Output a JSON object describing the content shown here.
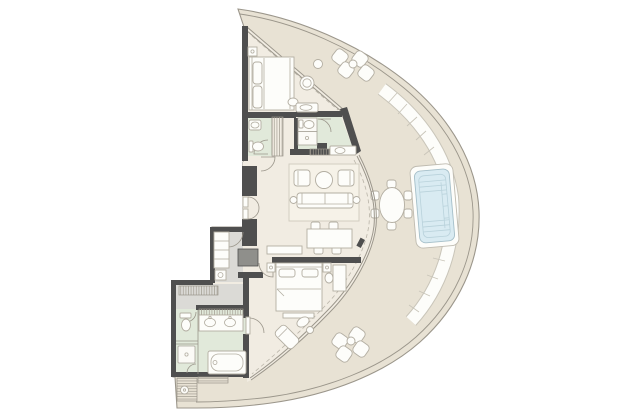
{
  "plan": {
    "kind": "apartment-floor-plan",
    "shape": "D-shaped plan: straight wall on the left, curved glass facade with wrap-around terrace on the right",
    "text_labels_visible": "none"
  },
  "palette": {
    "background": "#ffffff",
    "terrace_floor": "#e8e2d4",
    "interior_floor": "#f1ece2",
    "bathroom_floor": "#e1e9da",
    "hall_floor": "#dbdad6",
    "wall": "#4f4f4f",
    "partition": "#8a8a86",
    "furniture_fill": "#fdfdfa",
    "furniture_stroke": "#b3aea2",
    "glass_line": "#9b968b",
    "rug": "#f6f2e8",
    "pool_water": "#d9ebf2",
    "pool_edge": "#a5bfc9",
    "deck_outline": "#c9c5b9"
  },
  "rooms": {
    "terrace": "Curved terrace",
    "pool": "Plunge pool",
    "bedroom_1": "Bedroom 1",
    "bathroom_1": "Bathroom 1",
    "bathroom_2": "Bathroom 2",
    "living_room": "Living room",
    "dining_area": "Dining area",
    "bedroom_2": "Bedroom 2",
    "master_bathroom": "Master bathroom",
    "entry_hall": "Entry hall",
    "dressing_corridor": "Dressing corridor",
    "utility": "Utility unit"
  },
  "furniture": {
    "bedroom_1": [
      "double bed with two pillows",
      "nightstand with lamp",
      "round lounge chair",
      "ottoman",
      "built-in wardrobe strip"
    ],
    "bathroom_1": [
      "washbasin",
      "wc"
    ],
    "bathroom_2": [
      "wc stall",
      "shower stall",
      "vanity with basin"
    ],
    "living_room": [
      "three-seat sofa",
      "two armchairs",
      "round coffee table",
      "two round side tables",
      "area rug",
      "sideboard",
      "washbasin niche"
    ],
    "dining_area": [
      "rectangular table",
      "four chairs"
    ],
    "bedroom_2": [
      "double bed with two pillows",
      "two nightstands with lamps",
      "foot bench",
      "desk with stool",
      "chaise lounge",
      "pouf with side table"
    ],
    "master_bathroom": [
      "double vanity with two basins",
      "oval bathtub",
      "shower stall",
      "wc room",
      "linen door"
    ],
    "entry_hall": [
      "entry closet",
      "shoe cabinet",
      "service shaft"
    ],
    "dressing_corridor": [
      "hatched wardrobe run"
    ],
    "terrace": [
      "curved segmented sofa along glass",
      "plunge pool with steps and lounger",
      "oval dining table with six chairs",
      "upper cluster of four lounge chairs with drinks table",
      "lower cluster of four lounge chairs with drinks table",
      "small planter table"
    ],
    "utility": [
      "hatched equipment box with drum"
    ]
  },
  "counts": {
    "bedrooms": 2,
    "bathrooms": 3,
    "terrace_lounge_chairs": 8,
    "terrace_dining_seats": 6,
    "interior_dining_seats": 4
  }
}
